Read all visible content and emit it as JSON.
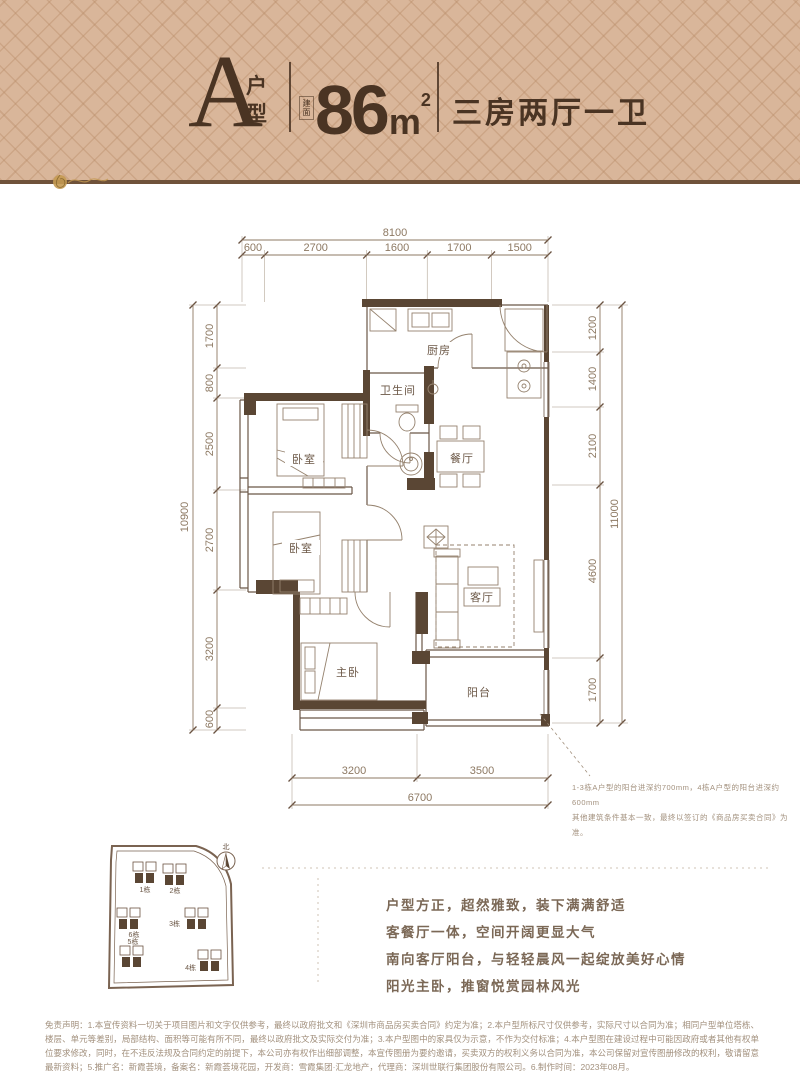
{
  "header": {
    "unit_letter": "A",
    "unit_word": "户型",
    "area_badge": "建面",
    "area_value": "86",
    "area_unit": "m",
    "area_power": "2",
    "layout": "三房两厅一卫"
  },
  "plan": {
    "dims_top": {
      "total": "8100",
      "segs": [
        "600",
        "2700",
        "1600",
        "1700",
        "1500"
      ]
    },
    "dims_left": {
      "total": "10900",
      "segs": [
        "1700",
        "800",
        "2500",
        "2700",
        "3200",
        "600"
      ]
    },
    "dims_right": {
      "total": "11000",
      "segs": [
        "1200",
        "1400",
        "2100",
        "4600",
        "1700"
      ]
    },
    "dims_bottom": {
      "total": "6700",
      "segs": [
        "3200",
        "3500"
      ]
    },
    "rooms": {
      "kitchen": "厨房",
      "bath": "卫生间",
      "bedroom1": "卧室",
      "bedroom2": "卧室",
      "dining": "餐厅",
      "living": "客厅",
      "master": "主卧",
      "balcony": "阳台"
    },
    "notes": [
      "1-3栋A户型的阳台进深约700mm，4栋A户型的阳台进深约600mm",
      "其他建筑条件基本一致，最终以签订的《商品房买卖合同》为准。"
    ]
  },
  "siteplan": {
    "north": "北",
    "buildings": [
      "1栋",
      "2栋",
      "3栋",
      "6栋",
      "5栋",
      "4栋"
    ]
  },
  "selling_points": [
    "户型方正，超然雅致，装下满满舒适",
    "客餐厅一体，空间开阔更显大气",
    "南向客厅阳台，与轻轻晨风一起绽放美好心情",
    "阳光主卧，推窗悦赏园林风光"
  ],
  "disclaimer": {
    "text": "免责声明：1.本宣传资料一切关于项目图片和文字仅供参考，最终以政府批文和《深圳市商品房买卖合同》约定为准；2.本户型所标尺寸仅供参考，实际尺寸以合同为准；相同户型单位塔栋、楼层、单元等差别，局部结构、面积等可能有所不同，最终以政府批文及实际交付为准；3.本户型图中的家具仅为示意，不作为交付标准；4.本户型图在建设过程中可能因政府或者其他有权单位要求修改，同时，在不违反法规及合同约定的前提下，本公司亦有权作出细部调整，本宣传图册为要约邀请，买卖双方的权利义务以合同为准，本公司保留对宣传图册修改的权利，敬请留意最新资料；5.推广名：新霞荟境，备案名：新霞荟境花园，开发商：雪霞集团·汇龙地产，代理商：深圳世联行集团股份有限公司。6.制作时间：2023年08月。"
  },
  "colors": {
    "header_bg": "#d9b69a",
    "header_text": "#4a3423",
    "wall_dark": "#5a4634",
    "line_brown": "#6b5748",
    "dim_text": "#8d7963",
    "gold": "#c49a52"
  }
}
